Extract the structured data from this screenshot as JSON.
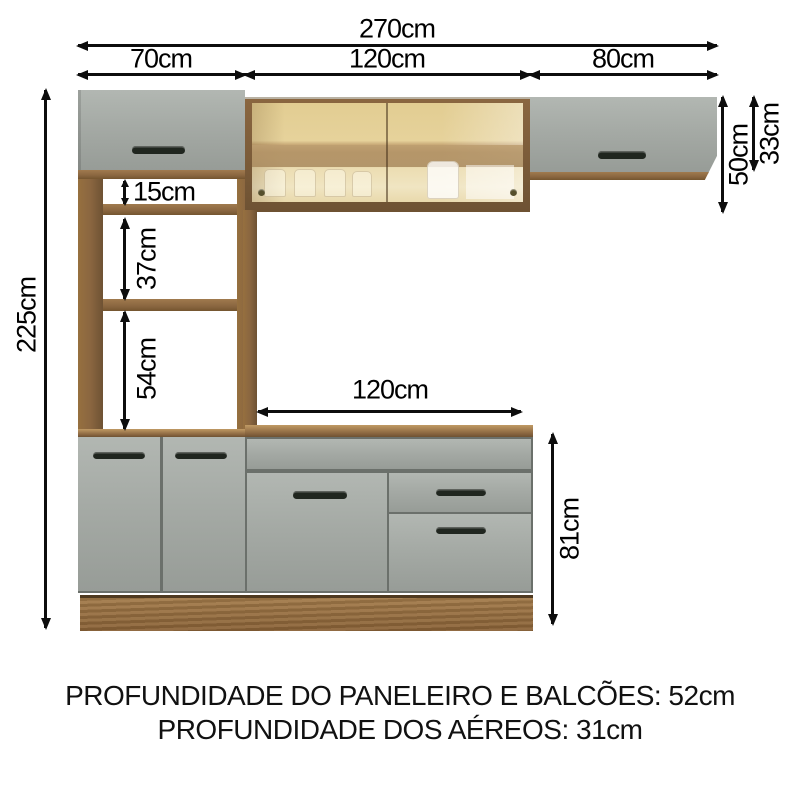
{
  "dimensions": {
    "total_width": "270cm",
    "left_width": "70cm",
    "middle_width": "120cm",
    "right_width": "80cm",
    "total_height": "225cm",
    "shelf_gap_1": "15cm",
    "shelf_gap_2": "37cm",
    "shelf_gap_3": "54cm",
    "counter_width": "120cm",
    "base_height": "81cm",
    "middle_aerial_height": "50cm",
    "right_aerial_height": "33cm"
  },
  "footer": {
    "line1": "PROFUNDIDADE DO PANELEIRO E BALCÕES: 52cm",
    "line2": "PROFUNDIDADE DOS AÉREOS: 31cm"
  },
  "colors": {
    "wood": "#8a6640",
    "wood_dark": "#6e5233",
    "cabinet_grey": "#a5aaa5",
    "glass_tint": "#e6d29b",
    "handle": "#20261f",
    "dimension_lines": "#0d0d0d",
    "background": "#ffffff"
  }
}
